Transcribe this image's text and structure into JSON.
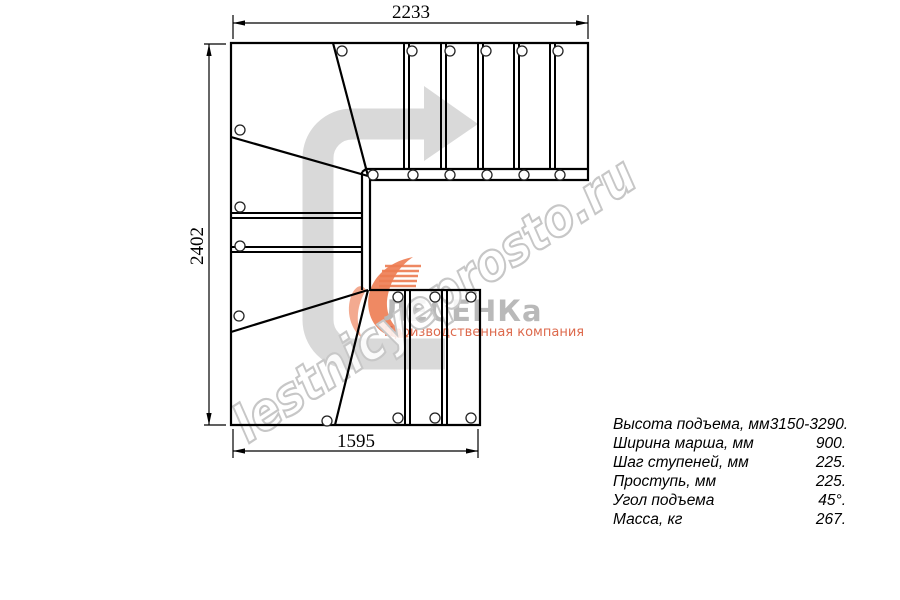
{
  "drawing": {
    "title": "staircase-plan-view",
    "dimensions": {
      "top": "2233",
      "left": "2402",
      "bottom": "1595"
    }
  },
  "watermark": {
    "text": "lestnicyeprosto.ru"
  },
  "logo": {
    "name": "ЛЕСЕНКа",
    "subtitle": "Производственная компания"
  },
  "specs": {
    "rows": [
      {
        "label": "Высота подъема, мм",
        "value": "3150-3290."
      },
      {
        "label": "Ширина марша, мм",
        "value": "900."
      },
      {
        "label": "Шаг ступеней, мм",
        "value": "225."
      },
      {
        "label": "Проступь, мм",
        "value": "225."
      },
      {
        "label": "Угол подъема",
        "value": "45°."
      },
      {
        "label": "Масса, кг",
        "value": "267."
      }
    ]
  },
  "colors": {
    "line": "#000000",
    "arrow_gray": "#d9d9d9",
    "watermark_gray": "#c7c7c7",
    "logo_orange": "#ed7c52",
    "logo_orange_light": "#f2a184",
    "logo_text_gray": "#b9b9b9"
  }
}
